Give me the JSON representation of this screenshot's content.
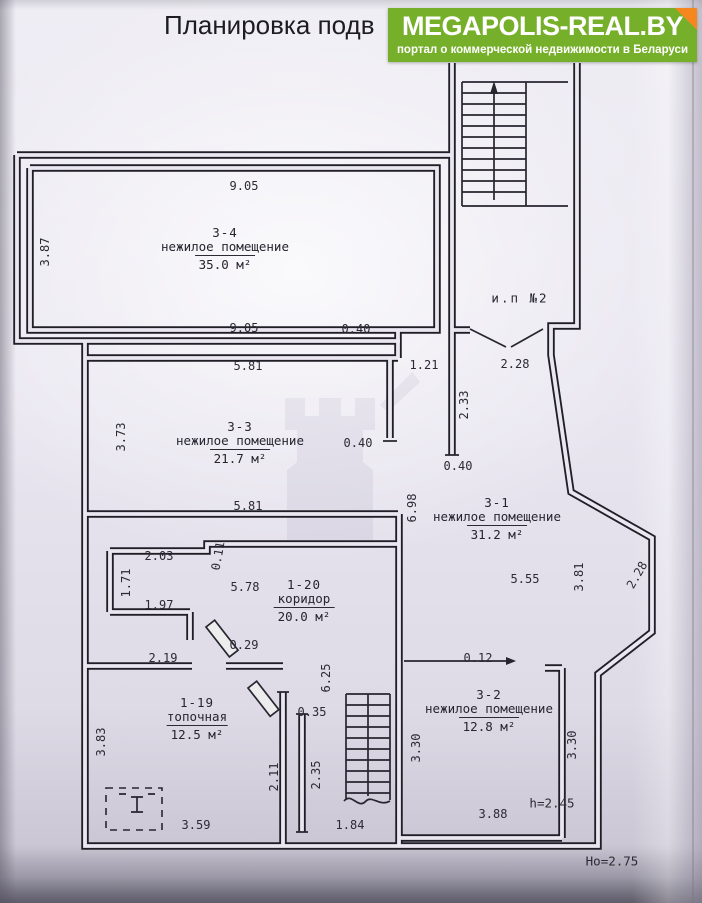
{
  "page": {
    "title": "Планировка подв"
  },
  "badge": {
    "brand": "MEGAPOLIS-REAL.BY",
    "tagline": "портал о коммерческой недвижимости в Беларуси",
    "bg": "#76b02a",
    "corner": "#f6871f"
  },
  "colors": {
    "ink": "#23222b",
    "paper": "#e9e6f0"
  },
  "plan": {
    "stairwell_label": {
      "text": "и.п №2",
      "x": 520,
      "y": 298
    },
    "rooms": [
      {
        "id": "3-4",
        "name": "нежилое помещение",
        "area": "35.0 м²",
        "x": 225,
        "y": 226
      },
      {
        "id": "3-3",
        "name": "нежилое помещение",
        "area": "21.7 м²",
        "x": 240,
        "y": 420
      },
      {
        "id": "3-1",
        "name": "нежилое помещение",
        "area": "31.2 м²",
        "x": 497,
        "y": 496
      },
      {
        "id": "1-20",
        "name": "коридор",
        "area": "20.0 м²",
        "x": 304,
        "y": 578
      },
      {
        "id": "1-19",
        "name": "топочная",
        "area": "12.5 м²",
        "x": 197,
        "y": 696
      },
      {
        "id": "3-2",
        "name": "нежилое помещение",
        "area": "12.8 м²",
        "x": 489,
        "y": 688
      }
    ],
    "dimensions": [
      {
        "t": "9.05",
        "x": 244,
        "y": 186,
        "r": 0
      },
      {
        "t": "3.87",
        "x": 45,
        "y": 252,
        "r": -90
      },
      {
        "t": "9.05",
        "x": 244,
        "y": 328,
        "r": 0
      },
      {
        "t": "0.40",
        "x": 356,
        "y": 329,
        "r": 0
      },
      {
        "t": "5.81",
        "x": 248,
        "y": 366,
        "r": 0
      },
      {
        "t": "1.21",
        "x": 424,
        "y": 365,
        "r": 0
      },
      {
        "t": "2.28",
        "x": 515,
        "y": 364,
        "r": 0
      },
      {
        "t": "2.33",
        "x": 464,
        "y": 405,
        "r": -90
      },
      {
        "t": "3.73",
        "x": 121,
        "y": 437,
        "r": -90
      },
      {
        "t": "0.40",
        "x": 358,
        "y": 443,
        "r": 0
      },
      {
        "t": "0.40",
        "x": 458,
        "y": 466,
        "r": 0
      },
      {
        "t": "5.81",
        "x": 248,
        "y": 506,
        "r": 0
      },
      {
        "t": "6.98",
        "x": 412,
        "y": 508,
        "r": -90
      },
      {
        "t": "5.55",
        "x": 525,
        "y": 579,
        "r": 0
      },
      {
        "t": "3.81",
        "x": 579,
        "y": 577,
        "r": -90
      },
      {
        "t": "2.28",
        "x": 637,
        "y": 575,
        "r": -60
      },
      {
        "t": "2.03",
        "x": 159,
        "y": 556,
        "r": 0
      },
      {
        "t": "0.11",
        "x": 218,
        "y": 556,
        "r": -80
      },
      {
        "t": "5.78",
        "x": 245,
        "y": 587,
        "r": 0
      },
      {
        "t": "1.71",
        "x": 126,
        "y": 583,
        "r": -90
      },
      {
        "t": "1.97",
        "x": 159,
        "y": 605,
        "r": 0
      },
      {
        "t": "2.19",
        "x": 163,
        "y": 658,
        "r": 0
      },
      {
        "t": "0.29",
        "x": 244,
        "y": 645,
        "r": 0
      },
      {
        "t": "6.25",
        "x": 326,
        "y": 678,
        "r": -90
      },
      {
        "t": "0.35",
        "x": 312,
        "y": 712,
        "r": 0
      },
      {
        "t": "0.12",
        "x": 478,
        "y": 658,
        "r": 0
      },
      {
        "t": "3.83",
        "x": 101,
        "y": 742,
        "r": -90
      },
      {
        "t": "2.11",
        "x": 274,
        "y": 777,
        "r": -90
      },
      {
        "t": "2.35",
        "x": 316,
        "y": 775,
        "r": -90
      },
      {
        "t": "3.30",
        "x": 416,
        "y": 748,
        "r": -90
      },
      {
        "t": "3.30",
        "x": 572,
        "y": 745,
        "r": -90
      },
      {
        "t": "3.59",
        "x": 196,
        "y": 825,
        "r": 0
      },
      {
        "t": "1.84",
        "x": 350,
        "y": 825,
        "r": 0
      },
      {
        "t": "3.88",
        "x": 493,
        "y": 814,
        "r": 0
      }
    ],
    "notes": [
      {
        "t": "h=2.45",
        "x": 552,
        "y": 803
      },
      {
        "t": "Но=2.75",
        "x": 612,
        "y": 861
      }
    ]
  }
}
